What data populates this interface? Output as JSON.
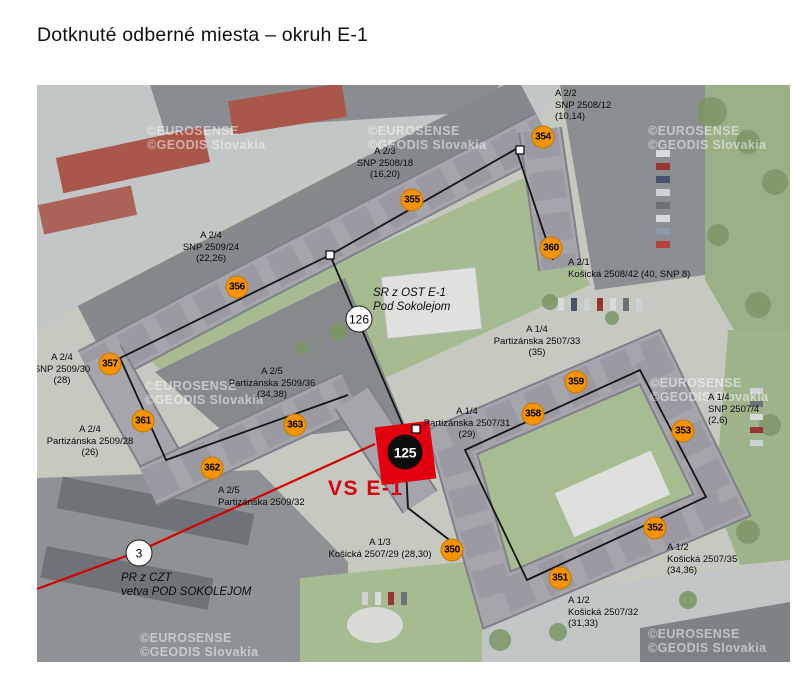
{
  "page": {
    "title": "Dotknuté odberné miesta – okruh E-1"
  },
  "map": {
    "colors": {
      "marker_orange": "#F59300",
      "accent_red": "#D6000E",
      "substation_black": "#0D0D0D"
    },
    "watermarks": {
      "line1": "©EUROSENSE",
      "line2": "©GEODIS Slovakia",
      "positions": [
        {
          "x": 147,
          "y": 124
        },
        {
          "x": 368,
          "y": 124
        },
        {
          "x": 648,
          "y": 124
        },
        {
          "x": 145,
          "y": 379
        },
        {
          "x": 650,
          "y": 376
        },
        {
          "x": 140,
          "y": 631
        },
        {
          "x": 648,
          "y": 627
        }
      ]
    },
    "vs_label": "VS E-1",
    "labels": [
      {
        "name": "label-a2-2",
        "text": "A 2/2\nSNP 2508/12\n(10,14)",
        "x": 555,
        "y": 88,
        "align": "left",
        "italic": false
      },
      {
        "name": "label-a2-3",
        "text": "A 2/3\nSNP 2508/18\n(16,20)",
        "x": 385,
        "y": 146,
        "align": "center",
        "italic": false
      },
      {
        "name": "label-a2-1",
        "text": "A 2/1\nKošická 2508/42 (40, SNP 8)",
        "x": 568,
        "y": 257,
        "align": "left",
        "italic": false
      },
      {
        "name": "label-a2-4-snp24",
        "text": "A 2/4\nSNP 2509/24\n(22,26)",
        "x": 211,
        "y": 230,
        "align": "center",
        "italic": false
      },
      {
        "name": "label-a2-4-snp30",
        "text": "A 2/4\nSNP 2509/30\n(28)",
        "x": 62,
        "y": 352,
        "align": "center",
        "italic": false
      },
      {
        "name": "label-a2-4-part28",
        "text": "A 2/4\nPartizánska 2509/28\n(26)",
        "x": 90,
        "y": 424,
        "align": "center",
        "italic": false
      },
      {
        "name": "label-a2-5-part36",
        "text": "A 2/5\nPartizánska 2509/36\n(34,38)",
        "x": 272,
        "y": 366,
        "align": "center",
        "italic": false
      },
      {
        "name": "label-a2-5-part32",
        "text": "A 2/5\nPartizánska 2509/32",
        "x": 218,
        "y": 485,
        "align": "left",
        "italic": false
      },
      {
        "name": "label-a1-4-part33",
        "text": "A 1/4\nPartizánska 2507/33\n(35)",
        "x": 537,
        "y": 324,
        "align": "center",
        "italic": false
      },
      {
        "name": "label-a1-4-part31",
        "text": "A 1/4\nPartizánska 2507/31\n(29)",
        "x": 467,
        "y": 406,
        "align": "center",
        "italic": false
      },
      {
        "name": "label-a1-4-snp4",
        "text": "A 1/4\nSNP 2507/4\n(2,6)",
        "x": 708,
        "y": 392,
        "align": "left",
        "italic": false
      },
      {
        "name": "label-a1-3",
        "text": "A 1/3\nKošická 2507/29 (28,30)",
        "x": 380,
        "y": 537,
        "align": "center",
        "italic": false
      },
      {
        "name": "label-a1-2-kos32",
        "text": "A 1/2\nKošická 2507/32\n(31,33)",
        "x": 568,
        "y": 595,
        "align": "left",
        "italic": false
      },
      {
        "name": "label-a1-2-kos35",
        "text": "A 1/2\nKošická 2507/35\n(34,36)",
        "x": 667,
        "y": 542,
        "align": "left",
        "italic": false
      },
      {
        "name": "label-sr-ost",
        "text": "SR z OST E-1\nPod Sokolejom",
        "x": 373,
        "y": 286,
        "align": "left",
        "italic": true
      },
      {
        "name": "label-pr-czt",
        "text": "PR z CZT\nvetva POD SOKOLEJOM",
        "x": 121,
        "y": 571,
        "align": "left",
        "italic": true
      }
    ],
    "markers": {
      "orange": [
        {
          "id": "350",
          "x": 452,
          "y": 550
        },
        {
          "id": "351",
          "x": 560,
          "y": 578
        },
        {
          "id": "352",
          "x": 655,
          "y": 528
        },
        {
          "id": "353",
          "x": 683,
          "y": 431
        },
        {
          "id": "354",
          "x": 543,
          "y": 137
        },
        {
          "id": "355",
          "x": 412,
          "y": 200
        },
        {
          "id": "356",
          "x": 237,
          "y": 287
        },
        {
          "id": "357",
          "x": 110,
          "y": 364
        },
        {
          "id": "358",
          "x": 533,
          "y": 414
        },
        {
          "id": "359",
          "x": 576,
          "y": 382
        },
        {
          "id": "360",
          "x": 551,
          "y": 248
        },
        {
          "id": "361",
          "x": 143,
          "y": 421
        },
        {
          "id": "362",
          "x": 212,
          "y": 468
        },
        {
          "id": "363",
          "x": 295,
          "y": 425
        }
      ],
      "white": [
        {
          "id": "126",
          "x": 359,
          "y": 319
        },
        {
          "id": "3",
          "x": 139,
          "y": 553
        }
      ],
      "substation": {
        "id": "125",
        "x": 405,
        "y": 452
      }
    }
  }
}
